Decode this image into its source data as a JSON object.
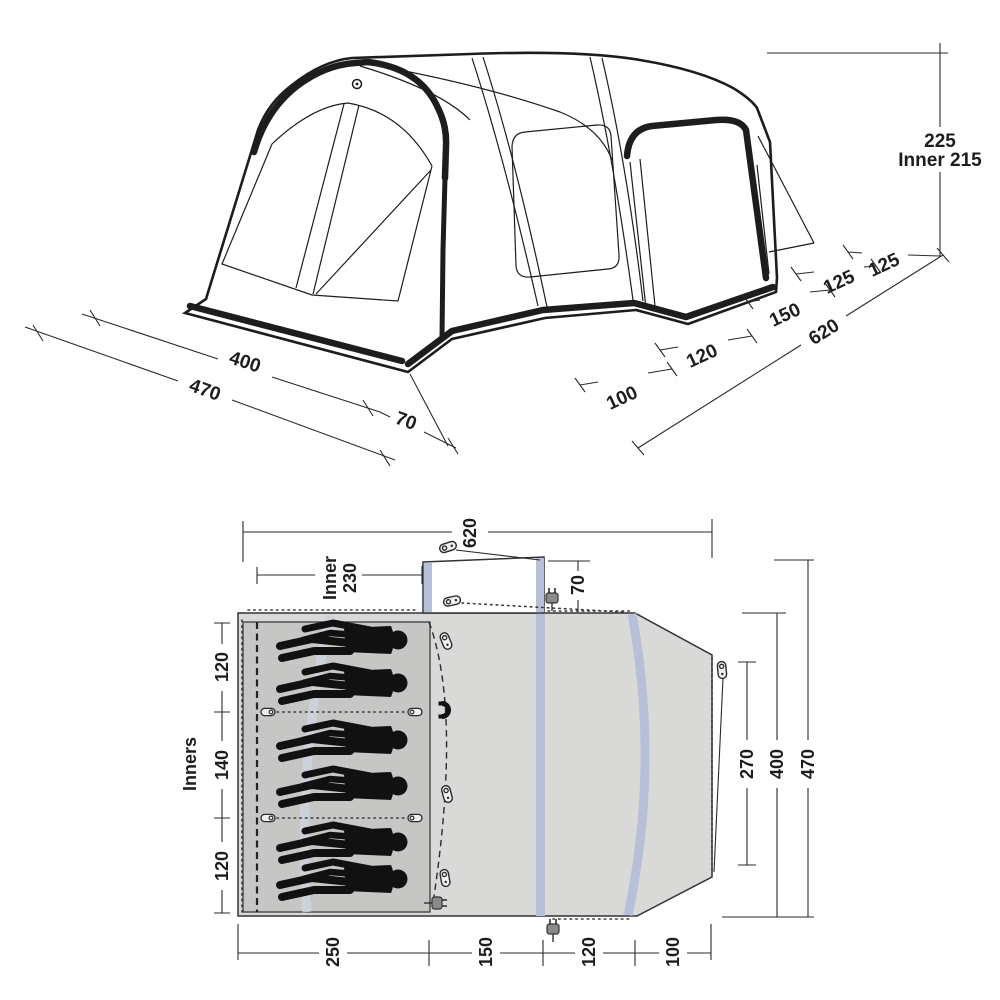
{
  "diagram_title": "Tent dimensions diagram (perspective view and floor plan)",
  "colors": {
    "line": "#1d1d1b",
    "plan_body_fill": "#d9dad8",
    "plan_inner_fill": "#c6c7c5",
    "air_beam_blue": "#b7c0d8",
    "inner_pole_band": "#ccd2dd",
    "canopy_fill": "#ffffff"
  },
  "view3d": {
    "description": "perspective line drawing of inflatable tunnel tent",
    "dims": {
      "height": "225",
      "inner_height": "Inner 215",
      "depth_seg_rear_a": "125",
      "depth_seg_rear_b": "125",
      "depth_seg_mid": "150",
      "depth_total": "620",
      "depth_seg_front_a": "120",
      "depth_seg_front_b": "100",
      "width_inner": "400",
      "width_total": "470",
      "width_porch": "70"
    }
  },
  "plan": {
    "description": "top-down floor plan with six sleepers",
    "sleeper_count": 6,
    "dims": {
      "depth_total": "620",
      "inner_width_line1": "Inner",
      "inner_width_line2": "230",
      "canopy_depth": "70",
      "left_sections": [
        "120",
        "140",
        "120"
      ],
      "inners_label": "Inners",
      "right_door": "270",
      "right_inner": "400",
      "right_total": "470",
      "bottom_sections": [
        "250",
        "150",
        "120",
        "100"
      ]
    },
    "icons": {
      "peg": "peg-icon",
      "toggle": "toggle-peg-icon",
      "plug": "power-plug-icon",
      "magnet": "magnet-icon"
    }
  }
}
